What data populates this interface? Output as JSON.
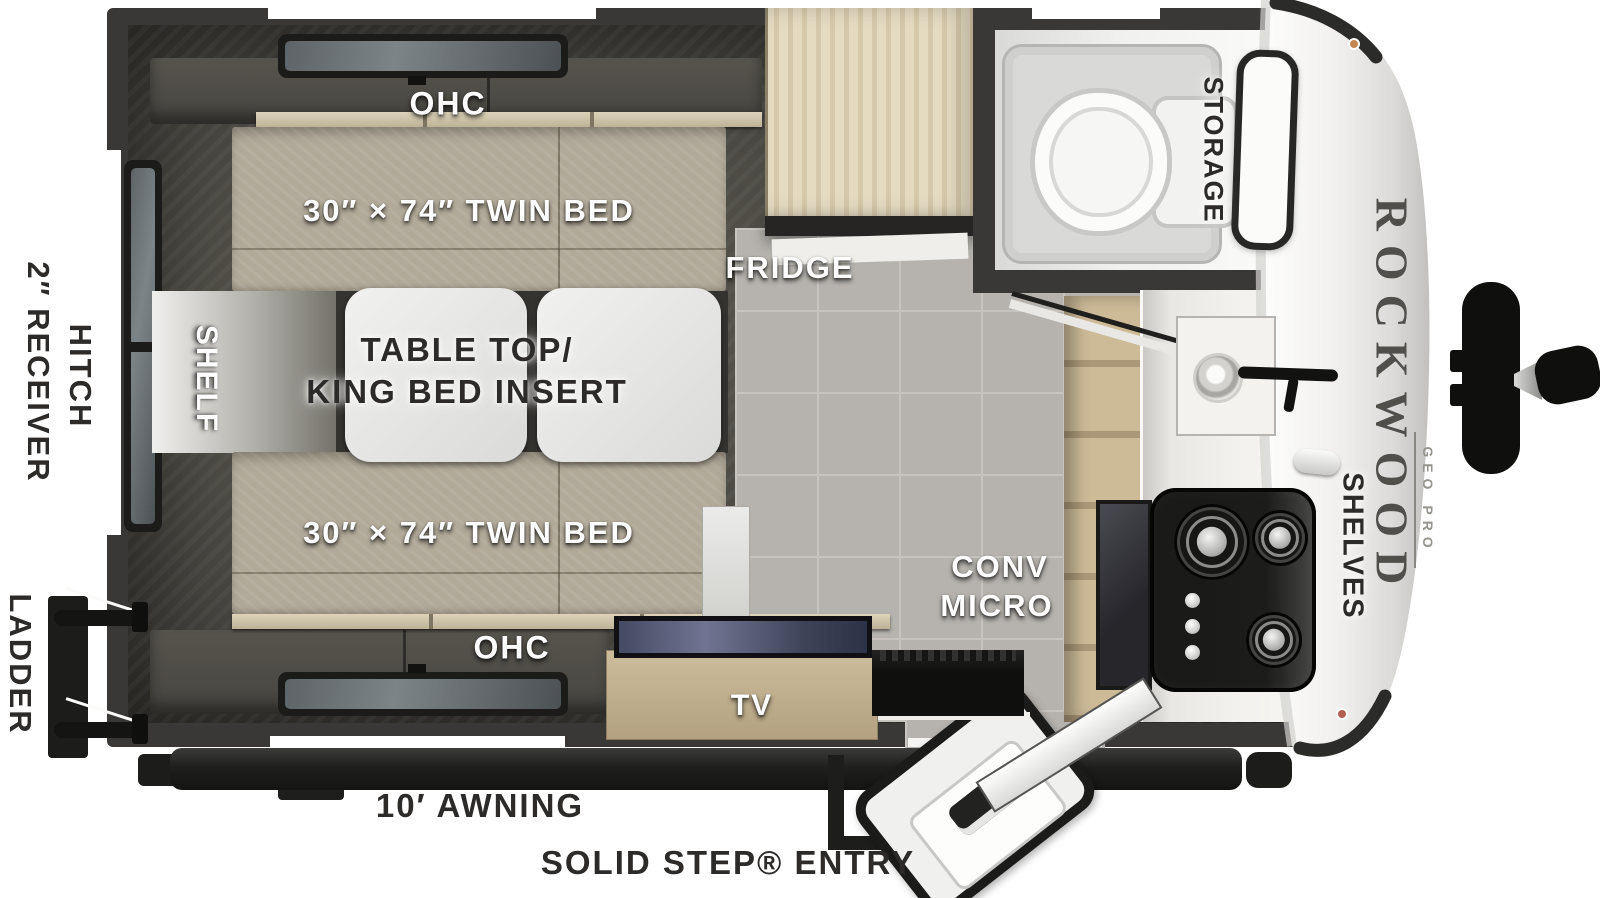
{
  "title": "Rockwood Geo Pro travel trailer floorplan",
  "bedroom": {
    "ohc_top": "OHC",
    "twin_bed_top": "30″ × 74″ TWIN BED",
    "table_line1": "TABLE TOP/",
    "table_line2": "KING BED INSERT",
    "shelf": "SHELF",
    "twin_bed_bottom": "30″ × 74″ TWIN BED",
    "ohc_bottom": "OHC",
    "tv": "TV"
  },
  "kitchen": {
    "fridge": "FRIDGE",
    "conv_line1": "CONV",
    "conv_line2": "MICRO",
    "shelves": "SHELVES"
  },
  "bathroom": {
    "storage": "STORAGE"
  },
  "exterior": {
    "ladder": "LADDER",
    "receiver_line1": "2″ RECEIVER",
    "receiver_line2": "HITCH",
    "awning": "10′ AWNING",
    "entry": "SOLID STEP® ENTRY",
    "brand": "ROCKWOOD",
    "brand_sub": "GEO PRO"
  },
  "colors": {
    "wall": "#393836",
    "bed_fabric": "#b2aa99",
    "wood_light": "#ddd2b6",
    "wood_mid": "#c9b795",
    "floor_tile": "#b6b3ae",
    "panel_white": "#e9e9e7",
    "label_light": "#fdfdfd",
    "label_dark": "#2c2b29",
    "appliance_black": "#161615"
  }
}
